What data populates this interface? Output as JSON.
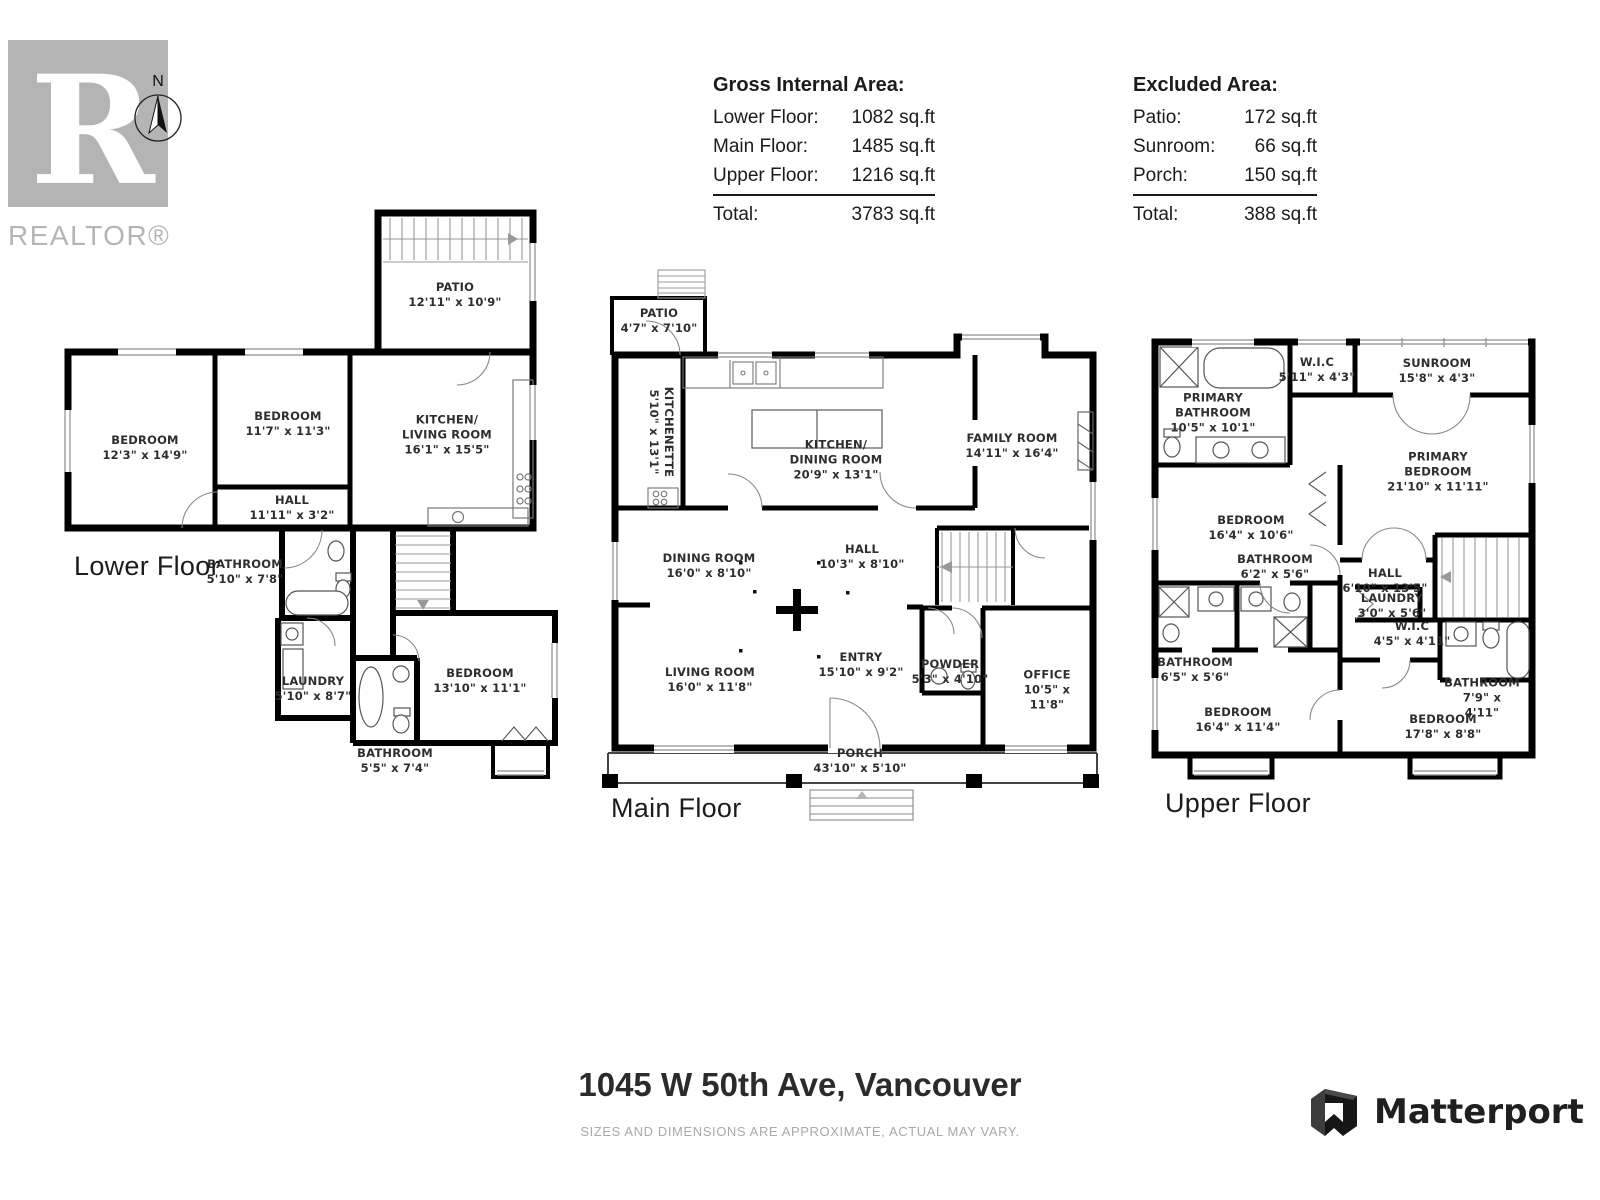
{
  "branding": {
    "realtor_text": "REALTOR®",
    "compass_n": "N",
    "matterport_text": "Matterport"
  },
  "area_summary": {
    "gross": {
      "title": "Gross Internal Area:",
      "rows": [
        {
          "label": "Lower Floor:",
          "value": "1082 sq.ft"
        },
        {
          "label": "Main Floor:",
          "value": "1485 sq.ft"
        },
        {
          "label": "Upper Floor:",
          "value": "1216 sq.ft"
        }
      ],
      "total": {
        "label": "Total:",
        "value": "3783 sq.ft"
      }
    },
    "excluded": {
      "title": "Excluded Area:",
      "rows": [
        {
          "label": "Patio:",
          "value": "172 sq.ft"
        },
        {
          "label": "Sunroom:",
          "value": "66 sq.ft"
        },
        {
          "label": "Porch:",
          "value": "150 sq.ft"
        }
      ],
      "total": {
        "label": "Total:",
        "value": "388 sq.ft"
      }
    }
  },
  "floors": [
    {
      "name": "Lower Floor",
      "rooms": [
        {
          "label": "PATIO",
          "dims": "12'11\" x 10'9\""
        },
        {
          "label": "BEDROOM",
          "dims": "12'3\" x 14'9\""
        },
        {
          "label": "BEDROOM",
          "dims": "11'7\" x 11'3\""
        },
        {
          "label": "KITCHEN/\nLIVING ROOM",
          "dims": "16'1\" x 15'5\""
        },
        {
          "label": "HALL",
          "dims": "11'11\" x 3'2\""
        },
        {
          "label": "BATHROOM",
          "dims": "5'10\" x 7'8\""
        },
        {
          "label": "LAUNDRY",
          "dims": "5'10\" x 8'7\""
        },
        {
          "label": "BEDROOM",
          "dims": "13'10\" x 11'1\""
        },
        {
          "label": "BATHROOM",
          "dims": "5'5\" x 7'4\""
        }
      ]
    },
    {
      "name": "Main Floor",
      "rooms": [
        {
          "label": "PATIO",
          "dims": "4'7\" x 7'10\""
        },
        {
          "label": "KITCHENETTE",
          "dims": "5'10\" x 13'1\""
        },
        {
          "label": "KITCHEN/\nDINING ROOM",
          "dims": "20'9\" x 13'1\""
        },
        {
          "label": "FAMILY ROOM",
          "dims": "14'11\" x 16'4\""
        },
        {
          "label": "DINING ROOM",
          "dims": "16'0\" x 8'10\""
        },
        {
          "label": "HALL",
          "dims": "10'3\" x 8'10\""
        },
        {
          "label": "LIVING ROOM",
          "dims": "16'0\" x 11'8\""
        },
        {
          "label": "ENTRY",
          "dims": "15'10\" x 9'2\""
        },
        {
          "label": "POWDER",
          "dims": "5'3\" x 4'10\""
        },
        {
          "label": "OFFICE",
          "dims": "10'5\" x 11'8\""
        },
        {
          "label": "PORCH",
          "dims": "43'10\" x 5'10\""
        }
      ]
    },
    {
      "name": "Upper Floor",
      "rooms": [
        {
          "label": "PRIMARY\nBATHROOM",
          "dims": "10'5\" x 10'1\""
        },
        {
          "label": "W.I.C",
          "dims": "5'11\" x 4'3\""
        },
        {
          "label": "SUNROOM",
          "dims": "15'8\" x 4'3\""
        },
        {
          "label": "PRIMARY\nBEDROOM",
          "dims": "21'10\" x 11'11\""
        },
        {
          "label": "BEDROOM",
          "dims": "16'4\" x 10'6\""
        },
        {
          "label": "BATHROOM",
          "dims": "6'2\" x 5'6\""
        },
        {
          "label": "HALL",
          "dims": "6'10\" x 13'5\""
        },
        {
          "label": "LAUNDRY",
          "dims": "3'0\" x 5'6\""
        },
        {
          "label": "W.I.C",
          "dims": "4'5\" x 4'11\""
        },
        {
          "label": "BATHROOM",
          "dims": "6'5\" x 5'6\""
        },
        {
          "label": "BATHROOM",
          "dims": "7'9\" x 4'11\""
        },
        {
          "label": "BEDROOM",
          "dims": "16'4\" x 11'4\""
        },
        {
          "label": "BEDROOM",
          "dims": "17'8\" x 8'8\""
        }
      ]
    }
  ],
  "footer": {
    "address": "1045 W 50th Ave, Vancouver",
    "disclaimer": "SIZES AND DIMENSIONS ARE APPROXIMATE, ACTUAL MAY VARY."
  }
}
